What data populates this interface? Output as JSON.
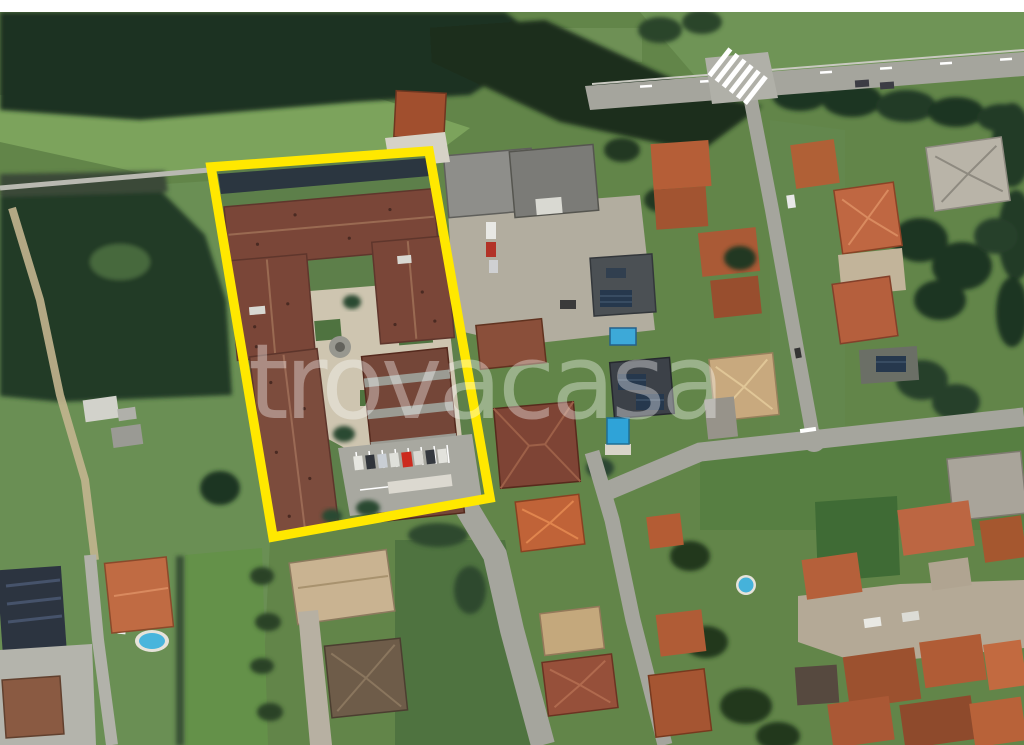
{
  "map": {
    "type": "satellite-aerial-photo",
    "watermark": "trovacasa",
    "highlight": {
      "shape": "rectangle-outline",
      "stroke_color": "#FFE800"
    },
    "palette": {
      "top_bar": "#FFFFFF",
      "forest_dark": "#1D3020",
      "grass": "#628549",
      "grass_light": "#7CA35C",
      "road_gray": "#A5A59D",
      "dirt_path": "#C3B58F",
      "courtyard_beige": "#CEC5B0",
      "roof_parcel_brown": "#7A4638",
      "roof_terracotta": "#BC6542",
      "roof_tan": "#C9B391",
      "roof_industrial_gray": "#8E8E8A",
      "solar_panel_blue": "#26384D",
      "pool_blue": "#45B2DA",
      "highlight_yellow": "#FFE800",
      "watermark_white": "#FFFFFF"
    }
  }
}
